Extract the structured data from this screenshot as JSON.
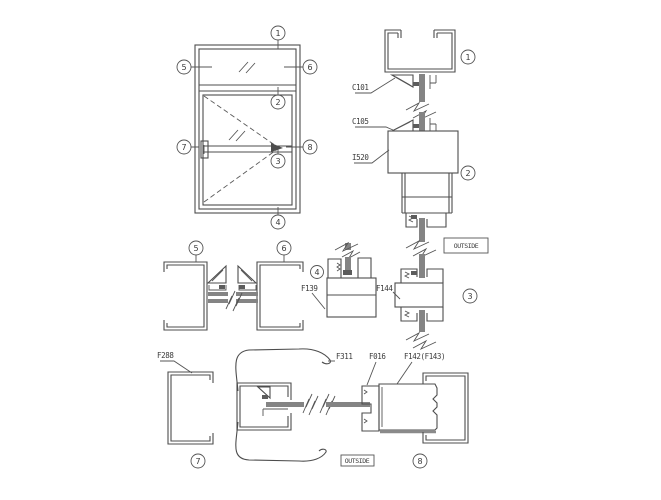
{
  "labels": {
    "outside": "OUTSIDE",
    "c101": "C101",
    "c105": "C105",
    "i520": "I520",
    "f139": "F139",
    "f144": "F144",
    "f288": "F288",
    "f311": "F311",
    "f016": "F016",
    "f142": "F142(F143)"
  },
  "callouts": {
    "n1": "1",
    "n2": "2",
    "n3": "3",
    "n4": "4",
    "n5": "5",
    "n6": "6",
    "n7": "7",
    "n8": "8"
  }
}
